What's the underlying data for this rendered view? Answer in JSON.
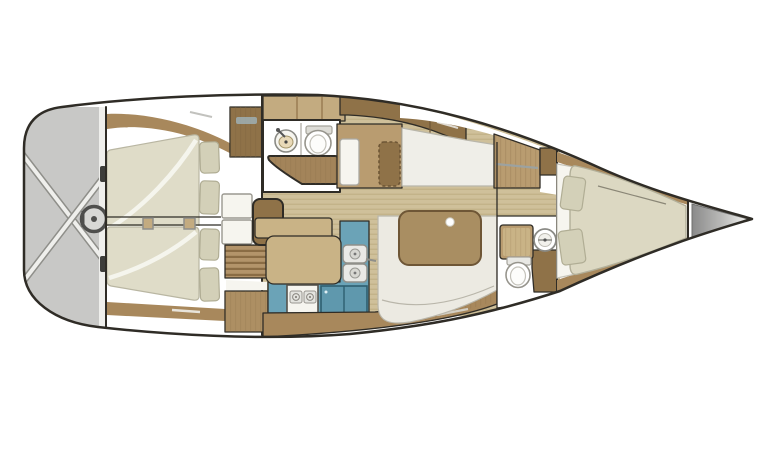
{
  "page": {
    "background": "#ffffff"
  },
  "colors": {
    "outline": "#2f2c26",
    "white": "#ffffff",
    "transom": "#c8c8c6",
    "strap": "#efefec",
    "wheel": "#4f4f4d",
    "wheel_fill": "#d8d8d5",
    "fitting": "#3d3d3a",
    "floor": "#cfc09a",
    "wood_dark": "#8f7248",
    "wood_mid": "#a8885c",
    "wood": "#b99c70",
    "wood_light": "#c9b386",
    "locker": "#c3ab80",
    "cab_face": "#ad8f63",
    "steps": "#b3946a",
    "mattress": "#dfdcc8",
    "bed": "#dcd8c2",
    "pillow": "#d3d0b8",
    "fold": "#f6f5ef",
    "cream": "#efeee8",
    "settee": "#eceae2",
    "teal": "#6ba3b7",
    "fridge": "#5f98ad",
    "steel": "#e9e9e6",
    "burner": "#e4e4df",
    "table": "#a98e62",
    "table_dot": "#ffffff",
    "bench": "#a3845a",
    "sink_bowl": "#e8d9b8",
    "glint": "#9fb3ba",
    "anchor_dark": "#8a8a8a",
    "anchor_light": "#f2f2f0"
  },
  "icons": {
    "steering_wheel": "ring-with-hub",
    "round_sink": "circle-basin-with-faucet",
    "double_sink": "twin-square-steel-basins",
    "toilet": "oval-bowl-with-tank",
    "stove": "two-burner-cooktop",
    "fridge": "blue-double-lid-box",
    "companionway_steps": "striped-stair-treads",
    "hanging_locker": "dashed-rounded-rectangle",
    "anchor_locker": "gray-gradient-wedge"
  }
}
